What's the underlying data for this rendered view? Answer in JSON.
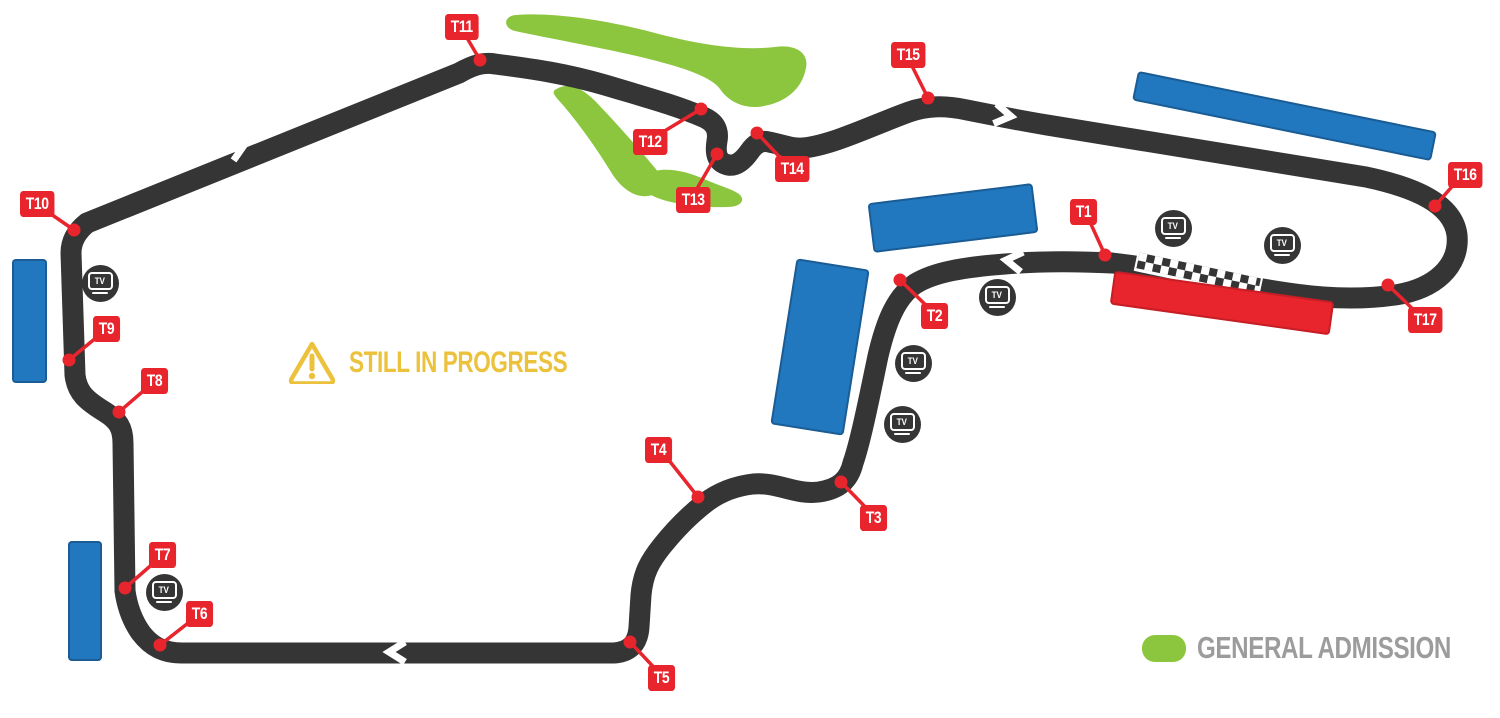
{
  "status_note": {
    "text": "STILL IN PROGRESS",
    "icon": "warning-triangle-icon",
    "color": "#ECC13C"
  },
  "legend": {
    "items": [
      {
        "label": "GENERAL ADMISSION",
        "swatch_color": "#8CC63E"
      }
    ]
  },
  "colors": {
    "track": "#353535",
    "turn_label": "#E8242D",
    "grandstand_blue": "#2178BE",
    "grandstand_red": "#E8242D",
    "general_admission_green": "#8CC63E",
    "status_yellow": "#ECC13C",
    "legend_text_gray": "#9C9C9C"
  },
  "track": {
    "stroke_width": 21,
    "direction_arrows": [
      {
        "x": 237,
        "y": 148,
        "angle": -23
      },
      {
        "x": 1003,
        "y": 115,
        "angle": 9
      },
      {
        "x": 1014,
        "y": 261,
        "angle": 187
      },
      {
        "x": 397,
        "y": 652,
        "angle": 180
      }
    ],
    "start_finish": {
      "x": 1136,
      "y": 249,
      "length": 128,
      "angle": 12
    }
  },
  "turns": [
    {
      "label": "T1",
      "box": [
        1070,
        199
      ],
      "dot": [
        1105,
        255
      ]
    },
    {
      "label": "T2",
      "box": [
        921,
        303
      ],
      "dot": [
        900,
        280
      ]
    },
    {
      "label": "T3",
      "box": [
        860,
        505
      ],
      "dot": [
        841,
        482
      ]
    },
    {
      "label": "T4",
      "box": [
        645,
        437
      ],
      "dot": [
        698,
        497
      ]
    },
    {
      "label": "T5",
      "box": [
        648,
        665
      ],
      "dot": [
        630,
        642
      ]
    },
    {
      "label": "T6",
      "box": [
        186,
        601
      ],
      "dot": [
        160,
        645
      ]
    },
    {
      "label": "T7",
      "box": [
        149,
        542
      ],
      "dot": [
        125,
        588
      ]
    },
    {
      "label": "T8",
      "box": [
        141,
        368
      ],
      "dot": [
        119,
        412
      ]
    },
    {
      "label": "T9",
      "box": [
        93,
        316
      ],
      "dot": [
        69,
        360
      ]
    },
    {
      "label": "T10",
      "box": [
        20,
        191
      ],
      "dot": [
        74,
        230
      ]
    },
    {
      "label": "T11",
      "box": [
        445,
        14
      ],
      "dot": [
        480,
        60
      ]
    },
    {
      "label": "T12",
      "box": [
        633,
        129
      ],
      "dot": [
        701,
        109
      ]
    },
    {
      "label": "T13",
      "box": [
        676,
        187
      ],
      "dot": [
        717,
        154
      ]
    },
    {
      "label": "T14",
      "box": [
        775,
        156
      ],
      "dot": [
        757,
        133
      ]
    },
    {
      "label": "T15",
      "box": [
        891,
        42
      ],
      "dot": [
        928,
        98
      ]
    },
    {
      "label": "T16",
      "box": [
        1448,
        162
      ],
      "dot": [
        1435,
        206
      ]
    },
    {
      "label": "T17",
      "box": [
        1408,
        307
      ],
      "dot": [
        1388,
        285
      ]
    }
  ],
  "tv_cameras": {
    "label": "TV",
    "positions": [
      [
        100,
        283
      ],
      [
        164,
        592
      ],
      [
        997,
        297
      ],
      [
        913,
        363
      ],
      [
        902,
        424
      ],
      [
        1173,
        228
      ],
      [
        1282,
        245
      ]
    ]
  },
  "grandstands": [
    {
      "type": "blue",
      "cx": 29,
      "cy": 321,
      "w": 35,
      "h": 124,
      "rot": 0
    },
    {
      "type": "blue",
      "cx": 85,
      "cy": 601,
      "w": 34,
      "h": 120,
      "rot": 0
    },
    {
      "type": "blue",
      "cx": 1284,
      "cy": 116,
      "w": 305,
      "h": 30,
      "rot": 11.5
    },
    {
      "type": "blue",
      "cx": 953,
      "cy": 218,
      "w": 166,
      "h": 50,
      "rot": -7
    },
    {
      "type": "blue",
      "cx": 820,
      "cy": 347,
      "w": 74,
      "h": 168,
      "rot": 9
    },
    {
      "type": "red",
      "cx": 1222,
      "cy": 303,
      "w": 222,
      "h": 34,
      "rot": 8
    }
  ]
}
